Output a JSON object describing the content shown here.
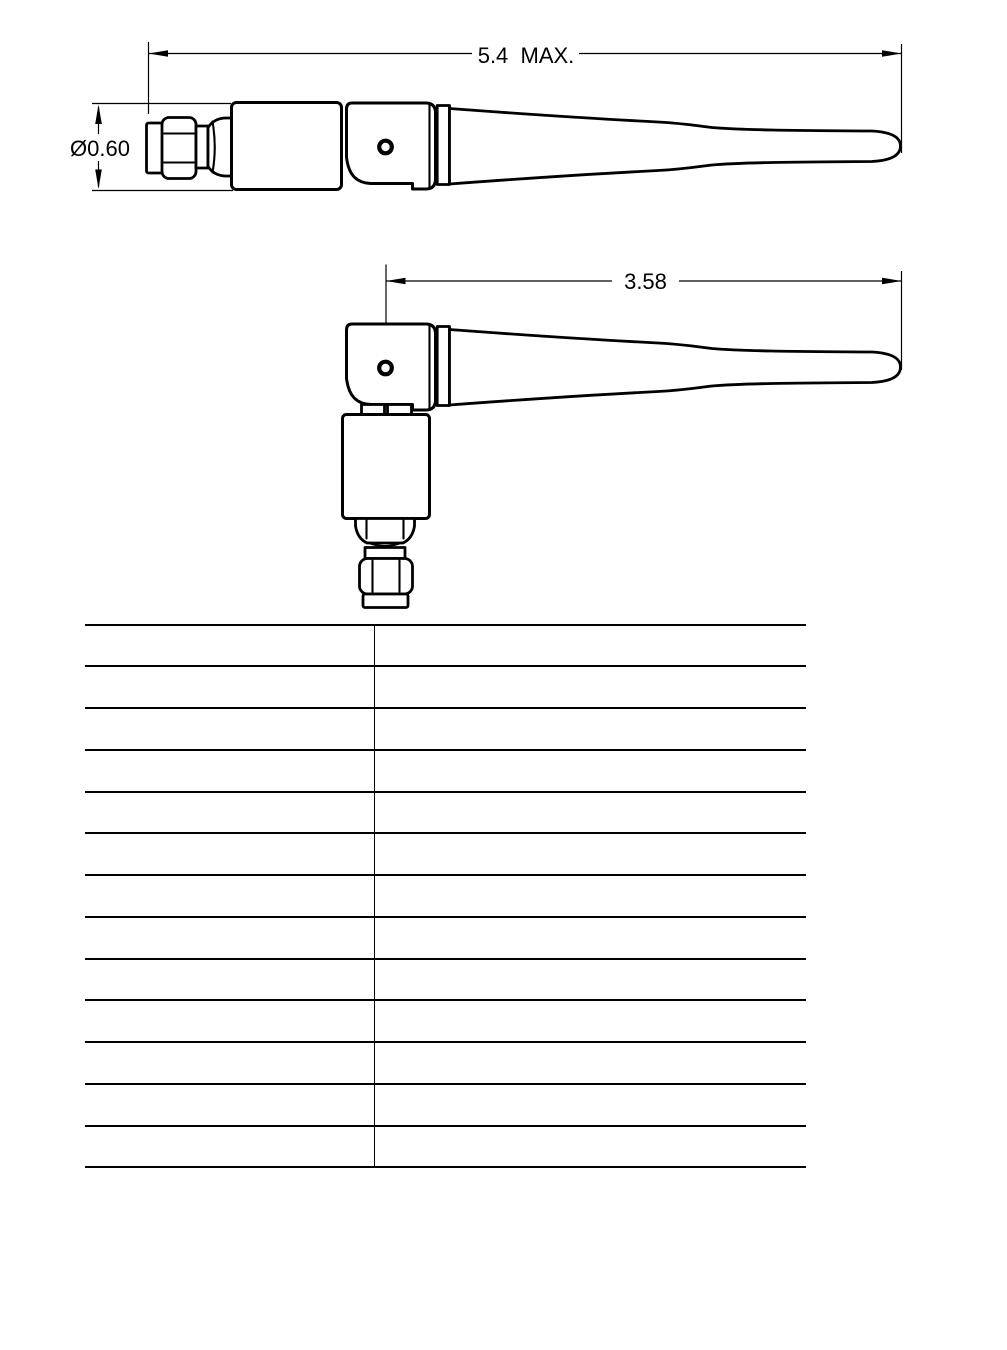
{
  "page": {
    "background": "#ffffff",
    "ink": "#000000",
    "kind": "antenna technical drawing sheet"
  },
  "drawings": {
    "straight_view": {
      "length_label": "5.4  MAX.",
      "diameter_label": "Ø0.60"
    },
    "folded_view": {
      "length_label": "3.58"
    }
  },
  "table": {
    "row_count": 13,
    "rows": [
      {
        "left": "",
        "right": ""
      },
      {
        "left": "",
        "right": ""
      },
      {
        "left": "",
        "right": ""
      },
      {
        "left": "",
        "right": ""
      },
      {
        "left": "",
        "right": ""
      },
      {
        "left": "",
        "right": ""
      },
      {
        "left": "",
        "right": ""
      },
      {
        "left": "",
        "right": ""
      },
      {
        "left": "",
        "right": ""
      },
      {
        "left": "",
        "right": ""
      },
      {
        "left": "",
        "right": ""
      },
      {
        "left": "",
        "right": ""
      },
      {
        "left": "",
        "right": ""
      }
    ]
  }
}
